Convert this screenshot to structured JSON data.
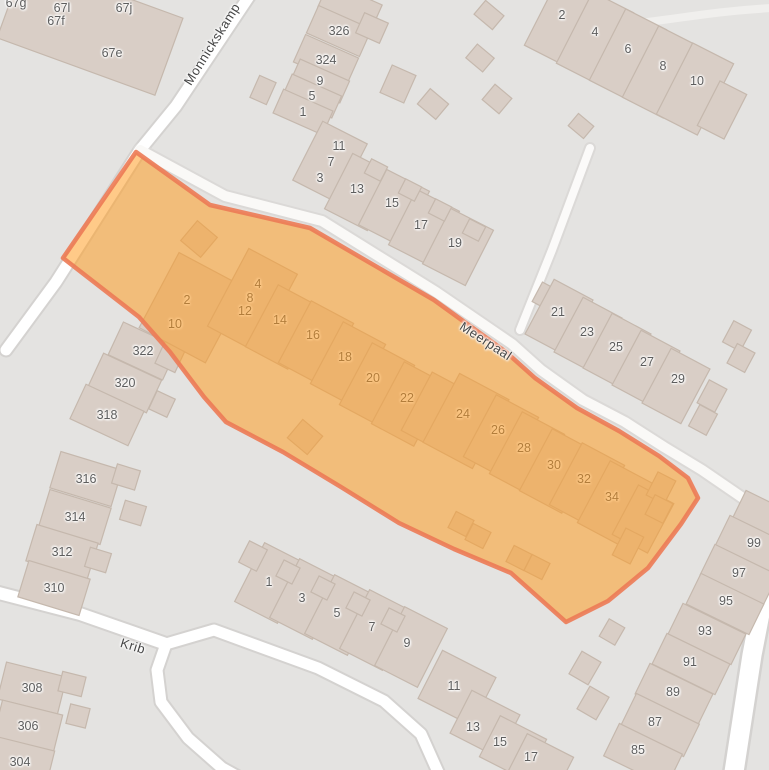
{
  "map": {
    "streets": [
      {
        "name": "Monnickskamp",
        "x": 212,
        "y": 44,
        "rotation": -58
      },
      {
        "name": "Meerpaal",
        "x": 486,
        "y": 341,
        "rotation": 33
      },
      {
        "name": "Krib",
        "x": 133,
        "y": 646,
        "rotation": 17
      }
    ],
    "house_numbers_outside": [
      {
        "label": "67g",
        "x": 16,
        "y": 3
      },
      {
        "label": "67l",
        "x": 62,
        "y": 8
      },
      {
        "label": "67j",
        "x": 124,
        "y": 8
      },
      {
        "label": "67f",
        "x": 56,
        "y": 21
      },
      {
        "label": "67e",
        "x": 112,
        "y": 53
      },
      {
        "label": "326",
        "x": 339,
        "y": 31
      },
      {
        "label": "324",
        "x": 326,
        "y": 60
      },
      {
        "label": "9",
        "x": 320,
        "y": 81
      },
      {
        "label": "5",
        "x": 312,
        "y": 96
      },
      {
        "label": "1",
        "x": 303,
        "y": 112
      },
      {
        "label": "11",
        "x": 339,
        "y": 146
      },
      {
        "label": "7",
        "x": 331,
        "y": 162
      },
      {
        "label": "3",
        "x": 320,
        "y": 178
      },
      {
        "label": "13",
        "x": 357,
        "y": 189
      },
      {
        "label": "15",
        "x": 392,
        "y": 203
      },
      {
        "label": "17",
        "x": 421,
        "y": 225
      },
      {
        "label": "19",
        "x": 455,
        "y": 243
      },
      {
        "label": "2",
        "x": 562,
        "y": 15
      },
      {
        "label": "4",
        "x": 595,
        "y": 32
      },
      {
        "label": "6",
        "x": 628,
        "y": 49
      },
      {
        "label": "8",
        "x": 663,
        "y": 66
      },
      {
        "label": "10",
        "x": 697,
        "y": 81
      },
      {
        "label": "21",
        "x": 558,
        "y": 312
      },
      {
        "label": "23",
        "x": 587,
        "y": 332
      },
      {
        "label": "25",
        "x": 616,
        "y": 347
      },
      {
        "label": "27",
        "x": 647,
        "y": 362
      },
      {
        "label": "29",
        "x": 678,
        "y": 379
      },
      {
        "label": "322",
        "x": 143,
        "y": 351
      },
      {
        "label": "320",
        "x": 125,
        "y": 383
      },
      {
        "label": "318",
        "x": 107,
        "y": 415
      },
      {
        "label": "316",
        "x": 86,
        "y": 479
      },
      {
        "label": "314",
        "x": 75,
        "y": 517
      },
      {
        "label": "312",
        "x": 62,
        "y": 552
      },
      {
        "label": "310",
        "x": 54,
        "y": 588
      },
      {
        "label": "308",
        "x": 32,
        "y": 688
      },
      {
        "label": "306",
        "x": 28,
        "y": 726
      },
      {
        "label": "304",
        "x": 20,
        "y": 762
      },
      {
        "label": "1",
        "x": 269,
        "y": 582
      },
      {
        "label": "3",
        "x": 302,
        "y": 598
      },
      {
        "label": "5",
        "x": 337,
        "y": 613
      },
      {
        "label": "7",
        "x": 372,
        "y": 627
      },
      {
        "label": "9",
        "x": 407,
        "y": 643
      },
      {
        "label": "11",
        "x": 454,
        "y": 686
      },
      {
        "label": "13",
        "x": 473,
        "y": 727
      },
      {
        "label": "15",
        "x": 500,
        "y": 742
      },
      {
        "label": "17",
        "x": 531,
        "y": 757
      },
      {
        "label": "99",
        "x": 754,
        "y": 543
      },
      {
        "label": "97",
        "x": 739,
        "y": 573
      },
      {
        "label": "95",
        "x": 726,
        "y": 601
      },
      {
        "label": "93",
        "x": 705,
        "y": 631
      },
      {
        "label": "91",
        "x": 690,
        "y": 662
      },
      {
        "label": "89",
        "x": 673,
        "y": 692
      },
      {
        "label": "87",
        "x": 655,
        "y": 722
      },
      {
        "label": "85",
        "x": 638,
        "y": 750
      }
    ],
    "house_numbers_inside_highlight": [
      {
        "label": "2",
        "x": 187,
        "y": 300
      },
      {
        "label": "10",
        "x": 175,
        "y": 324
      },
      {
        "label": "4",
        "x": 258,
        "y": 284
      },
      {
        "label": "8",
        "x": 250,
        "y": 298
      },
      {
        "label": "12",
        "x": 245,
        "y": 311
      },
      {
        "label": "14",
        "x": 280,
        "y": 320
      },
      {
        "label": "16",
        "x": 313,
        "y": 335
      },
      {
        "label": "18",
        "x": 345,
        "y": 357
      },
      {
        "label": "20",
        "x": 373,
        "y": 378
      },
      {
        "label": "22",
        "x": 407,
        "y": 398
      },
      {
        "label": "24",
        "x": 463,
        "y": 414
      },
      {
        "label": "26",
        "x": 498,
        "y": 430
      },
      {
        "label": "28",
        "x": 524,
        "y": 448
      },
      {
        "label": "30",
        "x": 554,
        "y": 465
      },
      {
        "label": "32",
        "x": 584,
        "y": 479
      },
      {
        "label": "34",
        "x": 612,
        "y": 497
      }
    ],
    "highlight": {
      "fill": "#ff9b1e",
      "fill_opacity": 0.53,
      "stroke": "#ec7a55",
      "stroke_opacity": 0.9,
      "stroke_width": 4.5
    }
  }
}
